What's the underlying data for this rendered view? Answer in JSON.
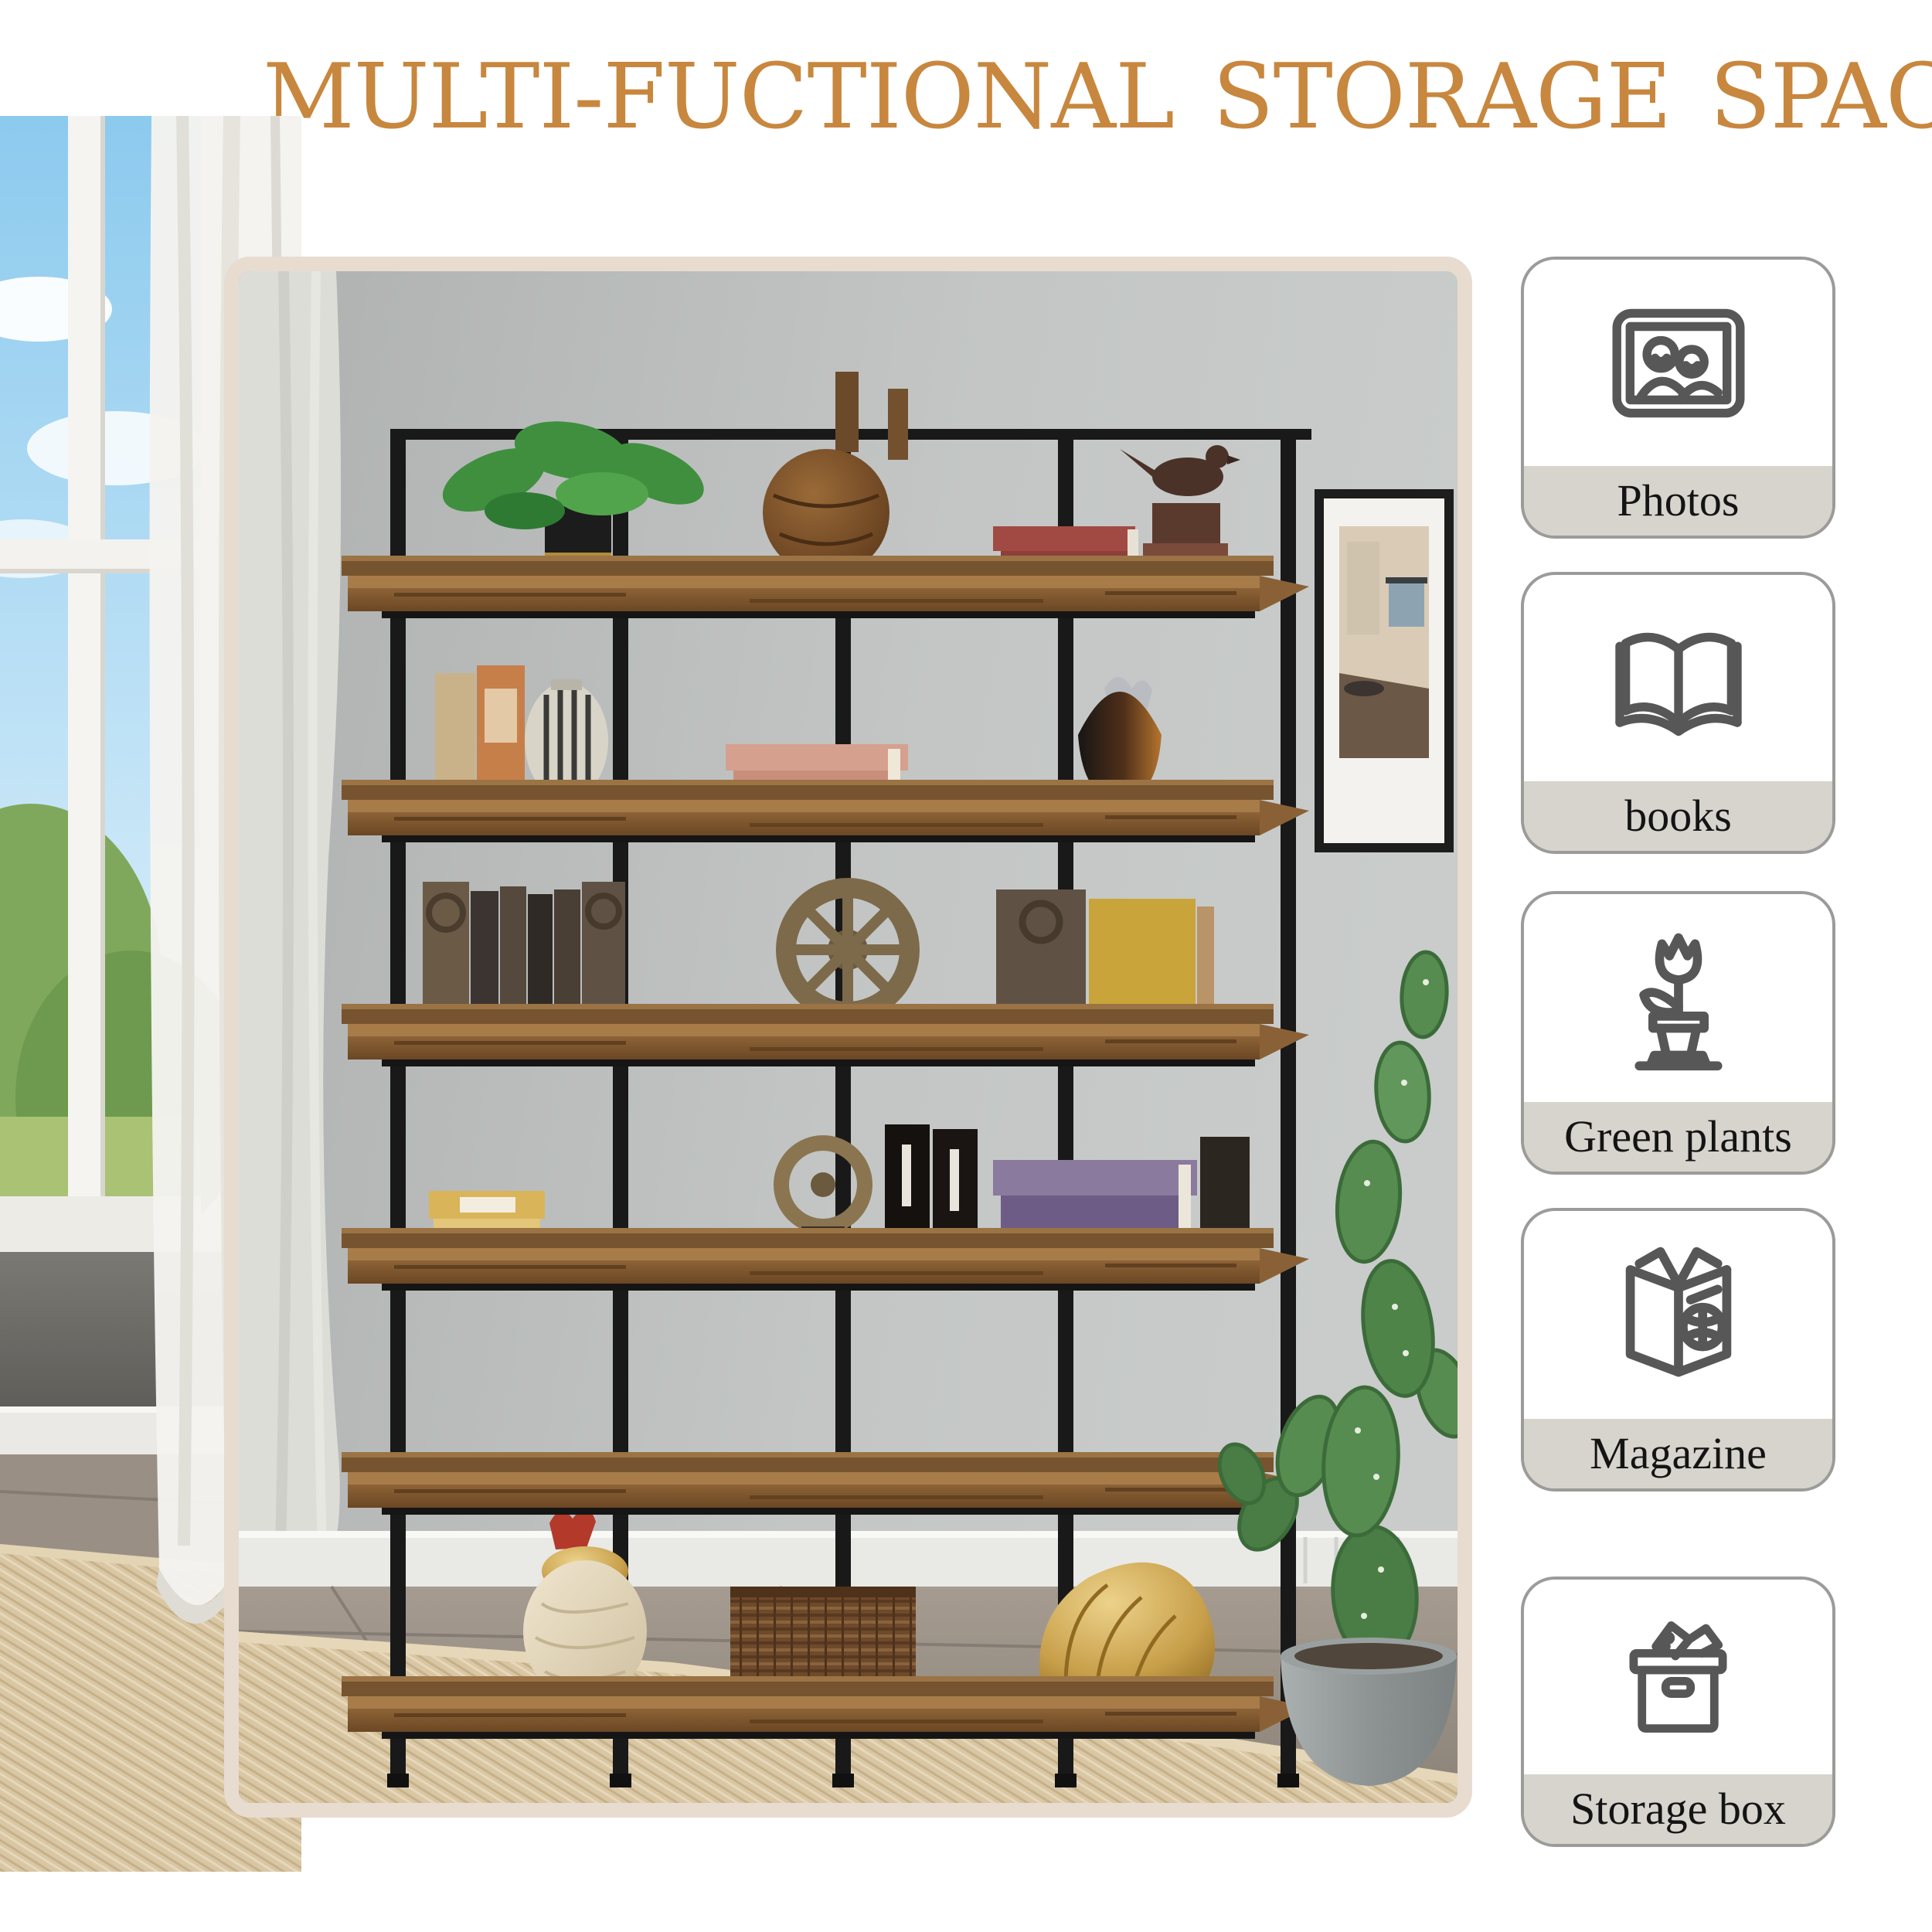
{
  "header": {
    "title": "MULTI-FUCTIONAL STORAGE SPACE"
  },
  "sidebar": {
    "items": [
      {
        "label": "Photos",
        "icon": "photo-frame-icon"
      },
      {
        "label": "books",
        "icon": "open-book-icon"
      },
      {
        "label": "Green plants",
        "icon": "potted-plant-icon"
      },
      {
        "label": "Magazine",
        "icon": "magazine-icon"
      },
      {
        "label": "Storage box",
        "icon": "storage-box-icon"
      }
    ]
  },
  "scene": {
    "type": "product-photo",
    "subject": "5-tier industrial bookshelf with rustic wood shelves and black metal frame",
    "elements": [
      "window-view",
      "sheer-curtain",
      "bookshelf",
      "decor-items",
      "wall-art",
      "cactus-plant",
      "jute-rug",
      "wood-floor"
    ]
  },
  "colors": {
    "accent_title": "#c8873e",
    "photo_frame_beige": "#e8dbd0",
    "badge_border": "#9b9b99",
    "badge_label_bg": "#d7d3cd",
    "icon_stroke": "#575757",
    "wall_gray": "#bcbfbe",
    "wood_brown": "#7f5a31",
    "rug_tan": "#d9c6a3"
  }
}
